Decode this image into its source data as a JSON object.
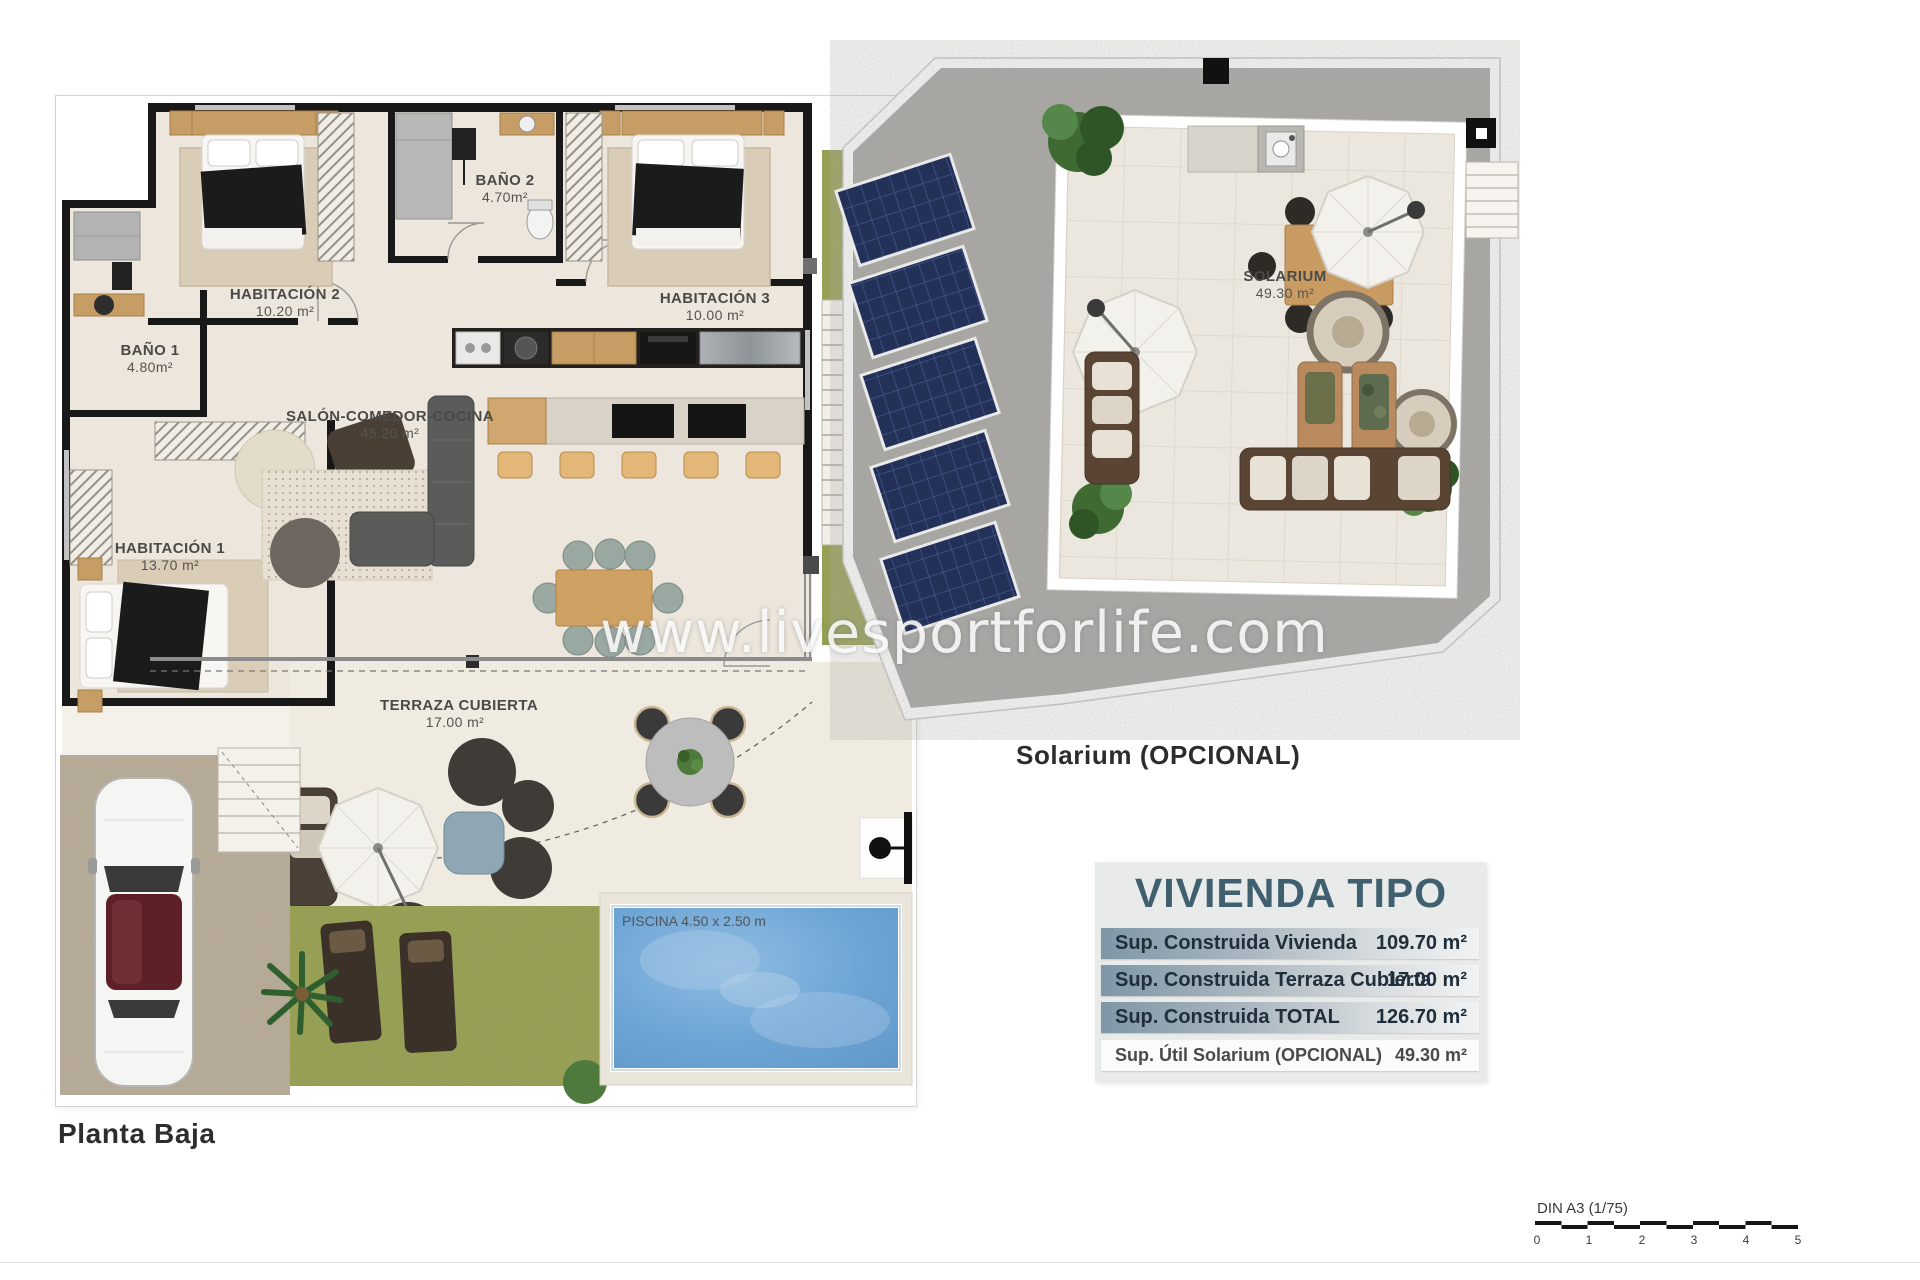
{
  "page": {
    "background": "#ffffff"
  },
  "watermark": {
    "text": "www.livesportforlife.com"
  },
  "planta_baja": {
    "caption": "Planta Baja",
    "rooms": [
      {
        "name": "HABITACIÓN 2",
        "area": "10.20 m²"
      },
      {
        "name": "BAÑO 2",
        "area": "4.70m²"
      },
      {
        "name": "HABITACIÓN 3",
        "area": "10.00 m²"
      },
      {
        "name": "BAÑO 1",
        "area": "4.80m²"
      },
      {
        "name": "HABITACIÓN 1",
        "area": "13.70 m²"
      },
      {
        "name": "SALÓN-COMEDOR-COCINA",
        "area": "45.20 m²"
      },
      {
        "name": "TERRAZA CUBIERTA",
        "area": "17.00 m²"
      }
    ],
    "pool_label": "PISCINA 4.50 x 2.50 m"
  },
  "solarium": {
    "caption": "Solarium (OPCIONAL)",
    "room": {
      "name": "SOLARIUM",
      "area": "49.30 m²"
    },
    "solar_panels_count": 5
  },
  "summary_table": {
    "title": "VIVIENDA TIPO",
    "accent_color": "#40606f",
    "rows": [
      {
        "label": "Sup. Construida Vivienda",
        "value": "109.70 m²"
      },
      {
        "label": "Sup. Construida Terraza Cubierta",
        "value": "17.00 m²"
      },
      {
        "label": "Sup. Construida TOTAL",
        "value": "126.70 m²"
      },
      {
        "label": "Sup. Útil Solarium (OPCIONAL)",
        "value": "49.30 m²"
      }
    ]
  },
  "scale_bar": {
    "label": "DIN A3 (1/75)",
    "ticks": [
      "0",
      "1",
      "2",
      "3",
      "4",
      "5"
    ]
  }
}
